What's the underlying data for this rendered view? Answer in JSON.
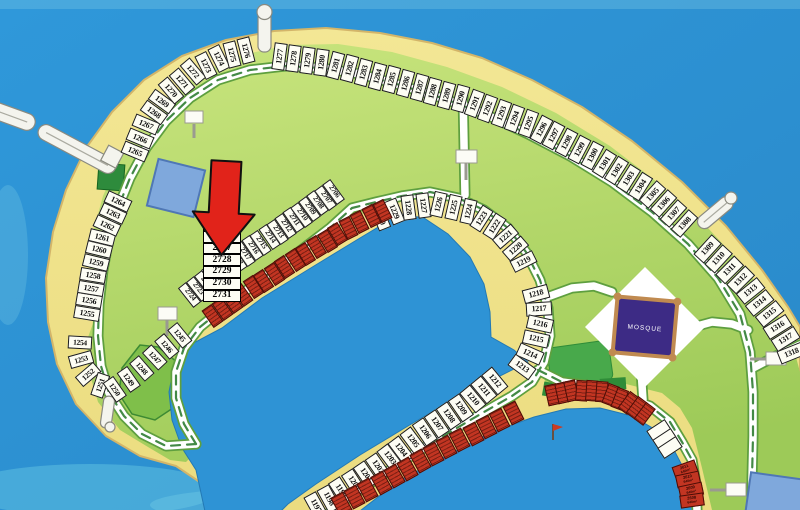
{
  "map": {
    "mosque": {
      "label": "MOSQUE"
    },
    "arrow": {
      "description": "red-arrow-marker",
      "points_to_plot": "2719",
      "color": "#E1231A"
    },
    "colors": {
      "ocean": "#2E93D5",
      "sand": "#F1E48C",
      "sand_edge": "#D3B569",
      "green_light": "#C8E47D",
      "green_dark": "#9DCA58",
      "road": "#FFFFFF",
      "verge": "#5E9F3F",
      "median": "#2F7D32",
      "plot_white": "#FDFDF4",
      "plot_red": "#C23522",
      "mosque_purple": "#3D2B85",
      "mosque_trim": "#C08A50",
      "building_blue": "#7FA8DC"
    },
    "stacked_plots": {
      "labels": [
        "2725",
        "2726",
        "2727",
        "2728",
        "2729",
        "2730",
        "2731"
      ],
      "x": 203,
      "y": 219,
      "w": 38,
      "row_h": 11.8
    },
    "plot_groups": [
      {
        "id": "outer-left",
        "type": "white",
        "len": 26,
        "wid": 13,
        "labels": [
          "1255",
          "1256",
          "1257",
          "1258",
          "1259",
          "1260",
          "1261",
          "1262",
          "1263",
          "1264"
        ],
        "path": [
          [
            86,
            320
          ],
          [
            94,
            272
          ],
          [
            103,
            235
          ],
          [
            121,
            196
          ]
        ]
      },
      {
        "id": "outer-topleft",
        "type": "white",
        "len": 26,
        "wid": 13,
        "labels": [
          "1265",
          "1266",
          "1267",
          "1268",
          "1269",
          "1270",
          "1271",
          "1272",
          "1273",
          "1274",
          "1275",
          "1276"
        ],
        "path": [
          [
            132,
            158
          ],
          [
            147,
            122
          ],
          [
            168,
            93
          ],
          [
            194,
            71
          ],
          [
            222,
            57
          ],
          [
            253,
            49
          ]
        ]
      },
      {
        "id": "outer-top",
        "type": "white",
        "len": 27,
        "wid": 13,
        "labels": [
          "1277",
          "1278",
          "1279",
          "1280",
          "1281",
          "1282",
          "1283",
          "1284",
          "1285",
          "1286",
          "1287",
          "1288",
          "1289",
          "1290",
          "1291",
          "1292",
          "1293",
          "1294",
          "1295",
          "1296",
          "1297",
          "1298",
          "1299",
          "1300",
          "1301",
          "1302",
          "1303",
          "1304",
          "1305",
          "1306",
          "1307",
          "1308"
        ],
        "path": [
          [
            272,
            56
          ],
          [
            332,
            64
          ],
          [
            392,
            80
          ],
          [
            465,
            100
          ],
          [
            533,
            125
          ],
          [
            596,
            158
          ],
          [
            650,
            192
          ],
          [
            690,
            228
          ]
        ]
      },
      {
        "id": "outer-right",
        "type": "white",
        "len": 27,
        "wid": 13.5,
        "labels": [
          "1309",
          "1310",
          "1311",
          "1312",
          "1313",
          "1314",
          "1315",
          "1316",
          "1317",
          "1318"
        ],
        "path": [
          [
            702,
            244
          ],
          [
            726,
            266
          ],
          [
            750,
            290
          ],
          [
            771,
            316
          ],
          [
            786,
            340
          ],
          [
            794,
            360
          ]
        ]
      },
      {
        "id": "u-turn",
        "type": "white",
        "len": 24,
        "wid": 12.5,
        "fs": 7.5,
        "labels": [
          "1254",
          "1253",
          "1252",
          "1251",
          "1250",
          "1249",
          "1248",
          "1247",
          "1246",
          "1245"
        ],
        "path": [
          [
            80,
            334
          ],
          [
            79,
            352
          ],
          [
            84,
            370
          ],
          [
            96,
            384
          ],
          [
            114,
            390
          ],
          [
            134,
            376
          ],
          [
            150,
            362
          ],
          [
            164,
            349
          ],
          [
            176,
            339
          ],
          [
            187,
            330
          ]
        ]
      },
      {
        "id": "strip-row",
        "type": "white",
        "len": 25,
        "wid": 10.2,
        "fs": 7.2,
        "labels": [
          "2706",
          "2707",
          "2708",
          "2709",
          "2710",
          "2711",
          "2712",
          "2713",
          "2714",
          "2715",
          "2716",
          "2717",
          "2718",
          "2719",
          "2720",
          "2721",
          "2722",
          "2723",
          "2724"
        ],
        "path": [
          [
            337,
            189
          ],
          [
            300,
            216
          ],
          [
            262,
            242
          ],
          [
            224,
            268
          ],
          [
            186,
            298
          ]
        ]
      },
      {
        "id": "ring-top",
        "type": "white",
        "len": 25,
        "wid": 13,
        "labels": [
          "1230",
          "1229",
          "1228",
          "1227",
          "1226",
          "1225",
          "1224",
          "1223",
          "1222",
          "1221",
          "1220",
          "1219"
        ],
        "path": [
          [
            373,
            220
          ],
          [
            400,
            209
          ],
          [
            437,
            204
          ],
          [
            472,
            212
          ],
          [
            500,
            230
          ],
          [
            519,
            252
          ],
          [
            527,
            268
          ]
        ]
      },
      {
        "id": "ring-right",
        "type": "white",
        "len": 26,
        "wid": 14,
        "labels": [
          "1218",
          "1217",
          "1216",
          "1215",
          "1214",
          "1213"
        ],
        "path": [
          [
            534,
            286
          ],
          [
            539,
            305
          ],
          [
            540,
            322
          ],
          [
            536,
            340
          ],
          [
            528,
            358
          ],
          [
            517,
            373
          ]
        ]
      },
      {
        "id": "bottom-strip",
        "type": "white",
        "len": 26,
        "wid": 13.5,
        "labels": [
          "1197",
          "1198",
          "1199",
          "1200",
          "1201",
          "1202",
          "1203",
          "1204",
          "1205",
          "1206",
          "1207",
          "1208",
          "1209",
          "1210",
          "1211",
          "1212"
        ],
        "path": [
          [
            310,
            509
          ],
          [
            330,
            498
          ],
          [
            358,
            480
          ],
          [
            387,
            460
          ],
          [
            415,
            439
          ],
          [
            443,
            420
          ],
          [
            472,
            400
          ],
          [
            501,
            376
          ]
        ]
      },
      {
        "id": "red-strip",
        "type": "red",
        "len": 21,
        "wid": 12,
        "count": 17,
        "labels_illegible": true,
        "path": [
          [
            207,
            320
          ],
          [
            252,
            288
          ],
          [
            300,
            257
          ],
          [
            348,
            228
          ],
          [
            388,
            208
          ]
        ]
      },
      {
        "id": "red-bottom",
        "type": "red",
        "len": 21,
        "wid": 14,
        "count": 14,
        "labels_illegible": true,
        "path": [
          [
            335,
            508
          ],
          [
            380,
            484
          ],
          [
            430,
            456
          ],
          [
            480,
            430
          ],
          [
            520,
            410
          ]
        ]
      },
      {
        "id": "red-arc",
        "type": "red",
        "len": 21,
        "wid": 11.5,
        "count": 11,
        "labels_illegible": true,
        "path": [
          [
            548,
            396
          ],
          [
            575,
            390
          ],
          [
            602,
            392
          ],
          [
            628,
            402
          ],
          [
            648,
            417
          ]
        ]
      },
      {
        "id": "arc-white",
        "type": "white",
        "len": 22,
        "wid": 13,
        "count": 3,
        "path": [
          [
            656,
            426
          ],
          [
            673,
            452
          ]
        ]
      },
      {
        "id": "red-26xx",
        "type": "red red-labeled",
        "len": 24,
        "wid": 12.5,
        "fs": 4,
        "labels": [
          {
            "n": "2611",
            "a": "640m²"
          },
          {
            "n": "2610",
            "a": "640m²"
          },
          {
            "n": "2609",
            "a": "640m²"
          },
          {
            "n": "2608",
            "a": "640m²"
          }
        ],
        "path": [
          [
            683,
            464
          ],
          [
            688,
            478
          ],
          [
            691,
            492
          ],
          [
            693,
            506
          ]
        ]
      }
    ]
  }
}
